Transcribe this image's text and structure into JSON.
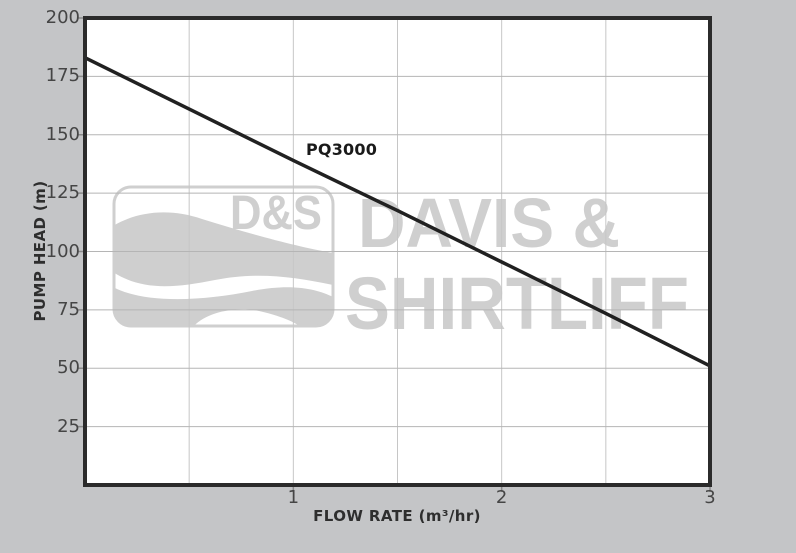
{
  "watermark": {
    "box_label": "D&S",
    "line1": "DAVIS &",
    "line2": "SHIRTLIFF"
  },
  "chart_data": {
    "type": "line",
    "title": "",
    "xlabel": "FLOW RATE (m³/hr)",
    "ylabel": "PUMP HEAD (m)",
    "xlim": [
      0,
      3
    ],
    "ylim": [
      0,
      200
    ],
    "xticks": [
      1,
      2,
      3
    ],
    "yticks": [
      25,
      50,
      75,
      100,
      125,
      150,
      175,
      200
    ],
    "x_gridlines": [
      0.5,
      1,
      1.5,
      2,
      2.5
    ],
    "y_gridlines": [
      25,
      50,
      75,
      100,
      125,
      150,
      175
    ],
    "grid": true,
    "legend": "none",
    "series": [
      {
        "name": "PQ3000",
        "x": [
          0,
          0.5,
          1,
          1.5,
          2,
          2.5,
          3
        ],
        "y": [
          183,
          161,
          139,
          117.5,
          95.5,
          73.5,
          51
        ]
      }
    ]
  },
  "colors": {
    "background": "#c4c5c7",
    "plot_bg": "#ffffff",
    "grid_h": "#b5b5b5",
    "grid_v": "#c6c6c6",
    "tick_stub": "#8a8a8a",
    "axis_border": "#2b2b2b",
    "curve": "#212121",
    "watermark": "#cfcfcf",
    "watermark_wave_gap": "#ffffff",
    "tick_text": "#454545",
    "axis_title_text": "#2e2e2e",
    "series_label_text": "#1a1a1a"
  }
}
